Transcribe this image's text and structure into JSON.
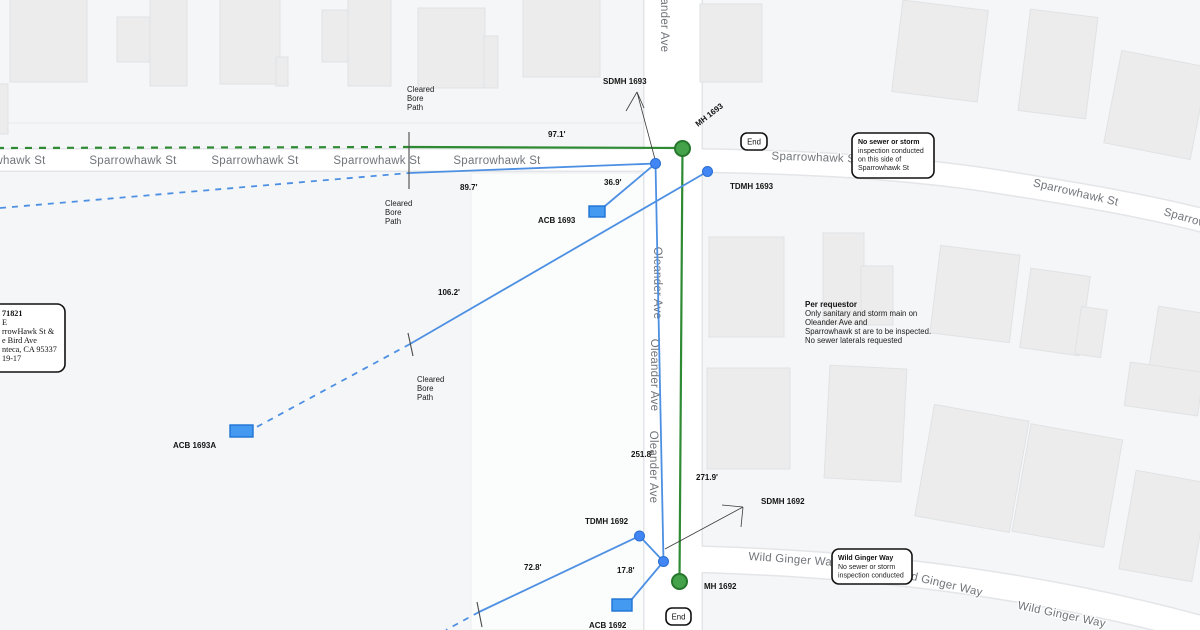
{
  "streets": {
    "sparrowhawk": "Sparrowhawk St",
    "oleander": "Oleander Ave",
    "wild_ginger": "Wild Ginger Way"
  },
  "features": {
    "sdmh_1693": "SDMH 1693",
    "mh_1693": "MH 1693",
    "tdmh_1693": "TDMH 1693",
    "acb_1693": "ACB 1693",
    "acb_1693a": "ACB 1693A",
    "tdmh_1692": "TDMH 1692",
    "sdmh_1692": "SDMH 1692",
    "mh_1692": "MH 1692",
    "acb_1692": "ACB 1692"
  },
  "distances": {
    "d97_1": "97.1'",
    "d89_7": "89.7'",
    "d36_9": "36.9'",
    "d106_2": "106.2'",
    "d251_8": "251.8'",
    "d271_9": "271.9'",
    "d72_8": "72.8'",
    "d17_8": "17.8'"
  },
  "bore_note": {
    "l1": "Cleared",
    "l2": "Bore",
    "l3": "Path"
  },
  "requestor_note": {
    "title": "Per requestor",
    "l1": "Only sanitary and storm main on",
    "l2": "Oleander Ave and",
    "l3": "Sparrowhawk st are to be inspected.",
    "l4": "No sewer laterals requested"
  },
  "callout_sparrowhawk": {
    "title": "No sewer or storm",
    "l1": "inspection conducted",
    "l2": "on this side of",
    "l3": "Sparrowhawk St"
  },
  "callout_wild_ginger": {
    "title": "Wild Ginger Way",
    "l1": "No sewer or storm",
    "l2": "inspection conducted"
  },
  "info_box": {
    "l1": "71821",
    "l2": "E",
    "l3": "rrowHawk St &",
    "l4": "e Bird Ave",
    "l5": "nteca, CA 95337",
    "l6": "19-17"
  },
  "end_label": "End",
  "colors": {
    "background": "#f5f6f7",
    "street_fill": "#ffffff",
    "street_casing": "#e3e5e8",
    "building_fill": "#ececec",
    "building_stroke": "#e0e2e4",
    "street_label": "#70757a",
    "annotation_text": "#141414",
    "green_line": "#2e8b34",
    "green_fill": "#44a24a",
    "green_stroke": "#26772c",
    "blue_line": "#4d90e3",
    "blue_dot": "#4285f4",
    "blue_dot_stroke": "#2a6fd0",
    "acb_fill": "#4499f0",
    "acb_stroke": "#1f72d4",
    "leader": "#3a3a3a"
  }
}
